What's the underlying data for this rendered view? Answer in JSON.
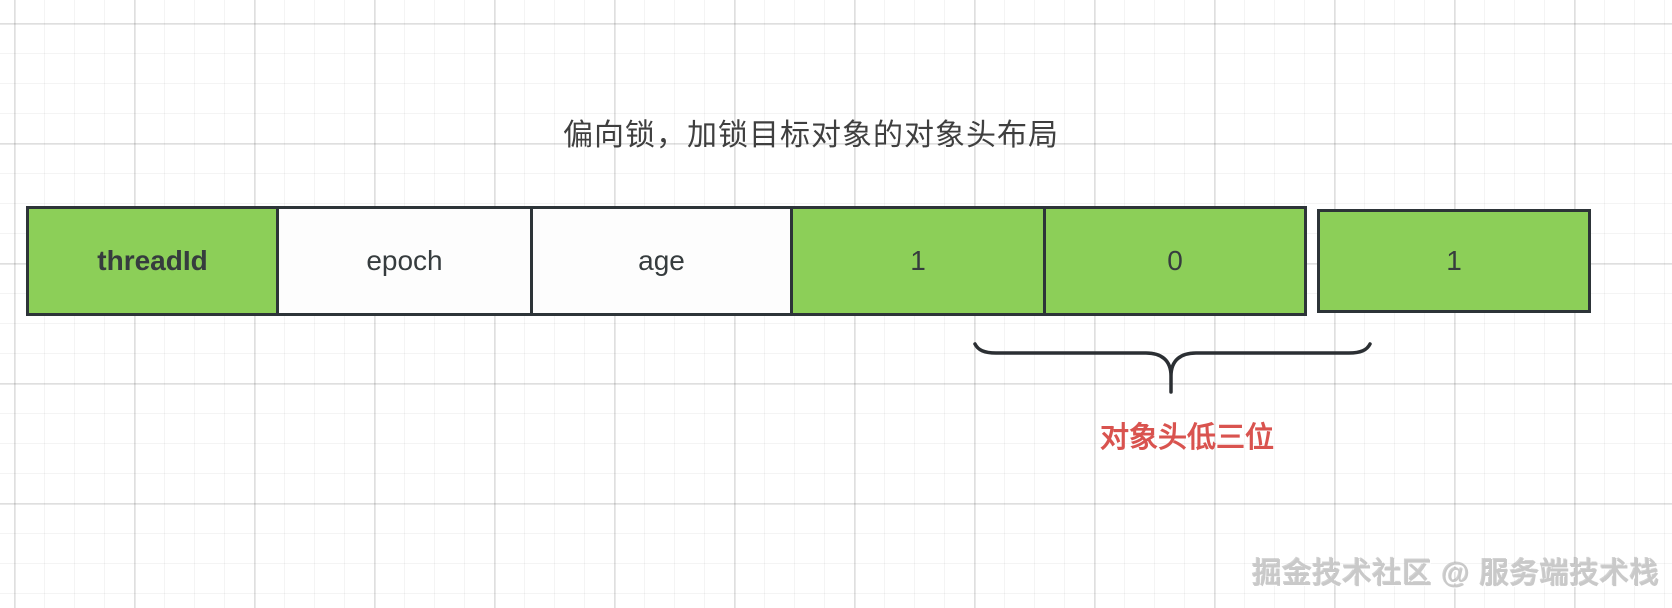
{
  "title": "偏向锁，加锁目标对象的对象头布局",
  "diagram": {
    "cells": [
      {
        "label": "threadId",
        "fill": "#8ccf58"
      },
      {
        "label": "epoch",
        "fill": "#fdfdfd"
      },
      {
        "label": "age",
        "fill": "#fdfdfd"
      },
      {
        "label": "1",
        "fill": "#8ccf58"
      },
      {
        "label": "0",
        "fill": "#8ccf58"
      }
    ],
    "detached_cell": {
      "label": "1",
      "fill": "#8ccf58"
    },
    "annotation": {
      "label": "对象头低三位",
      "color": "#d9534f"
    }
  },
  "colors": {
    "cell_green": "#8ccf58",
    "cell_border": "#2d3438",
    "annotation_red": "#d9534f",
    "title_text": "#3f3f3f"
  },
  "watermark": "掘金技术社区 @ 服务端技术栈"
}
